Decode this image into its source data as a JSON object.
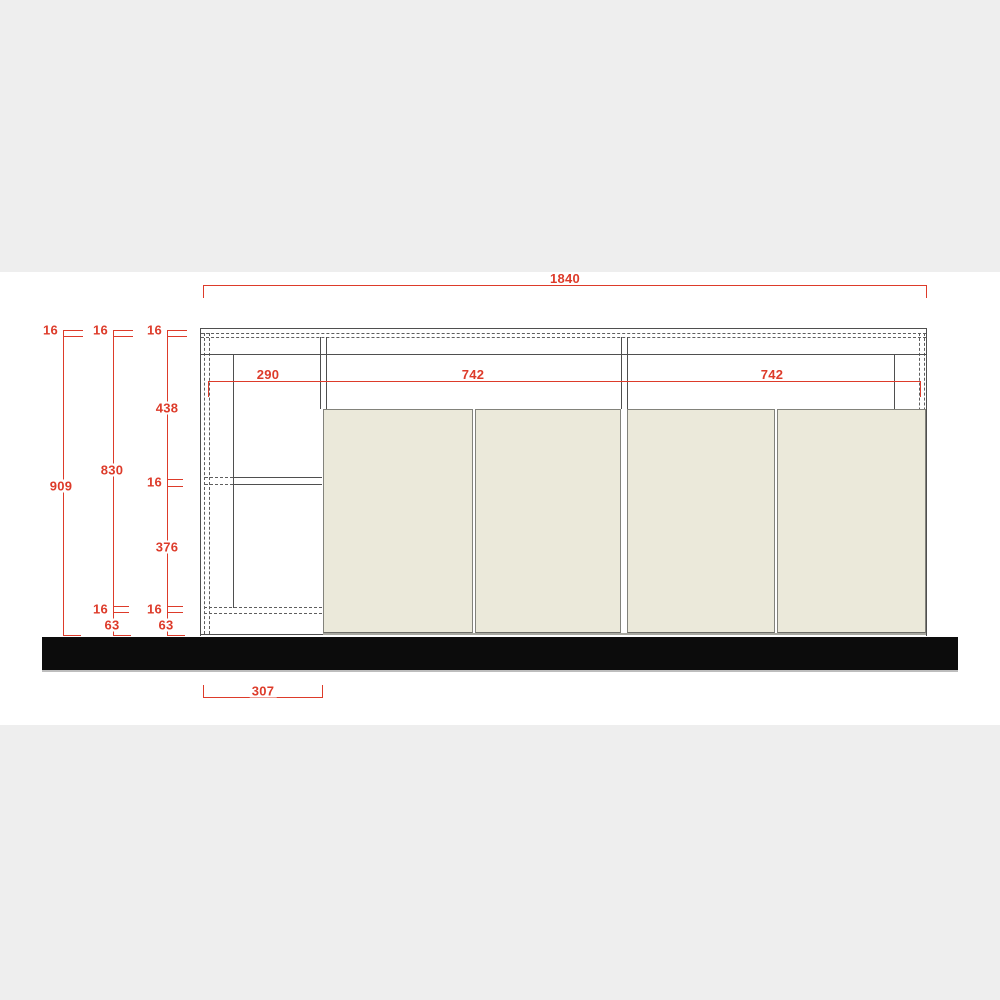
{
  "drawing": {
    "title": "sideboard-front-elevation-technical-drawing",
    "units": "mm",
    "colors": {
      "dimension_red": "#dd3b2a",
      "outline_dark": "#4f4f4f",
      "door_fill": "#ebe9da",
      "floor_bar_black": "#0c0c0c",
      "background_band_gray": "#eeeeee"
    }
  },
  "dims": {
    "total_width": "1840",
    "height_overall": "909",
    "height_body": "830",
    "panel_top_a": "16",
    "panel_top_b": "16",
    "panel_top_c": "16",
    "upper_compartment": "438",
    "shelf_panel": "16",
    "lower_compartment": "376",
    "panel_bottom_b": "16",
    "panel_bottom_c": "16",
    "plinth_b": "63",
    "plinth_c": "63",
    "niche_width": "290",
    "doors_left_pair": "742",
    "doors_right_pair": "742",
    "plinth_side_depth": "307"
  }
}
